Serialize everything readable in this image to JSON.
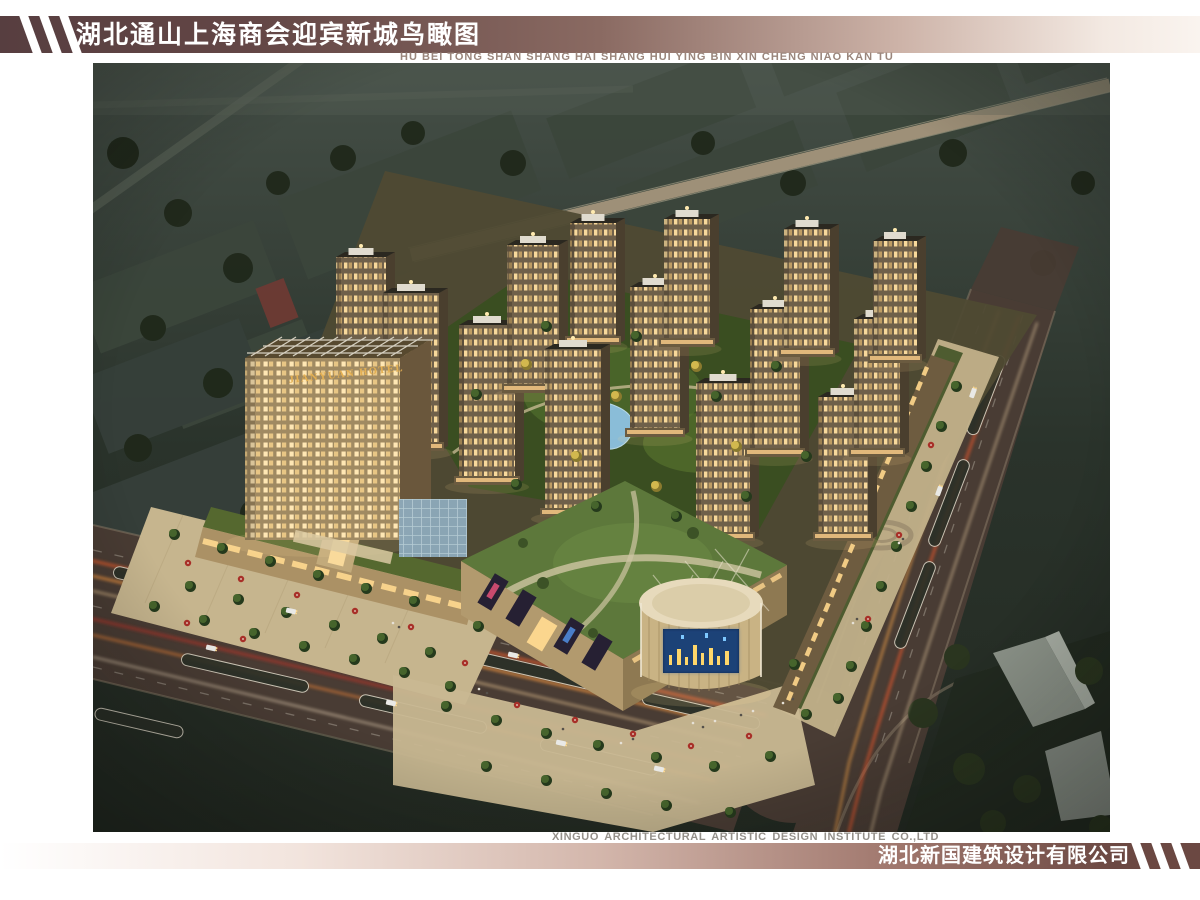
{
  "header": {
    "title_cn": "湖北通山上海商会迎宾新城鸟瞰图",
    "subtitle_pinyin": "HU BEI TONG SHAN SHANG HAI SHANG HUI YING BIN XIN CHENG NIAO KAN TU"
  },
  "footer": {
    "credit_en": "XINGUO ARCHITECTURAL ARTISTIC DESIGN INSTITUTE CO.,LTD",
    "company_cn": "湖北新国建筑设计有限公司"
  },
  "scene": {
    "hotel_sign": "JIANYUAN HOTEL",
    "colors": {
      "header_bar_dark": "#573e40",
      "header_bar_light": "#faf4ef",
      "title": "#ffffff",
      "pinyin": "#9a867c",
      "footer_bar_dark": "#6b4842",
      "footer_bar_light": "#ffffff",
      "credit": "#94908a",
      "company": "#ffffff",
      "night_ground": "#242c25",
      "tower_face": "#6f604a",
      "window_glow": "#ffdf9f",
      "lawn_roof": "#5d783b",
      "road": "#493c34",
      "light_trail": "#ff9c3e",
      "pond": "#8ec2e2",
      "plaza": "#c6b58e",
      "drum_roof": "#e7dabc",
      "led_screen": "#112a50",
      "hotel_sign_gold": "#e3af52"
    },
    "towers": [
      {
        "x": 268,
        "y": 332,
        "w": 50,
        "h": 138
      },
      {
        "x": 318,
        "y": 388,
        "w": 56,
        "h": 158
      },
      {
        "x": 394,
        "y": 422,
        "w": 56,
        "h": 160
      },
      {
        "x": 440,
        "y": 330,
        "w": 52,
        "h": 148
      },
      {
        "x": 500,
        "y": 282,
        "w": 46,
        "h": 122
      },
      {
        "x": 480,
        "y": 454,
        "w": 56,
        "h": 168
      },
      {
        "x": 562,
        "y": 374,
        "w": 50,
        "h": 150
      },
      {
        "x": 594,
        "y": 284,
        "w": 46,
        "h": 128
      },
      {
        "x": 630,
        "y": 478,
        "w": 54,
        "h": 158
      },
      {
        "x": 682,
        "y": 394,
        "w": 50,
        "h": 148
      },
      {
        "x": 714,
        "y": 294,
        "w": 46,
        "h": 128
      },
      {
        "x": 750,
        "y": 478,
        "w": 50,
        "h": 144
      },
      {
        "x": 784,
        "y": 394,
        "w": 46,
        "h": 138
      },
      {
        "x": 802,
        "y": 300,
        "w": 44,
        "h": 122
      }
    ],
    "trees": [
      [
        80,
        470,
        "s"
      ],
      [
        128,
        484,
        "s"
      ],
      [
        176,
        497,
        "s"
      ],
      [
        224,
        511,
        "s"
      ],
      [
        272,
        524,
        "s"
      ],
      [
        320,
        537,
        "s"
      ],
      [
        96,
        522,
        "s"
      ],
      [
        144,
        535,
        "s"
      ],
      [
        192,
        548,
        "s"
      ],
      [
        240,
        561,
        "s"
      ],
      [
        288,
        574,
        "s"
      ],
      [
        336,
        588,
        "s"
      ],
      [
        384,
        562,
        "s"
      ],
      [
        60,
        542,
        "s"
      ],
      [
        110,
        556,
        "s"
      ],
      [
        160,
        569,
        "s"
      ],
      [
        210,
        582,
        "s"
      ],
      [
        260,
        595,
        "s"
      ],
      [
        310,
        608,
        "s"
      ],
      [
        356,
        622,
        "s"
      ],
      [
        862,
        322,
        "s"
      ],
      [
        847,
        362,
        "s"
      ],
      [
        832,
        402,
        "s"
      ],
      [
        817,
        442,
        "s"
      ],
      [
        802,
        482,
        "s"
      ],
      [
        787,
        522,
        "s"
      ],
      [
        772,
        562,
        "s"
      ],
      [
        757,
        602,
        "s"
      ],
      [
        744,
        634,
        "s"
      ],
      [
        352,
        642,
        "s"
      ],
      [
        402,
        656,
        "s"
      ],
      [
        452,
        669,
        "s"
      ],
      [
        504,
        681,
        "s"
      ],
      [
        562,
        693,
        "s"
      ],
      [
        620,
        702,
        "s"
      ],
      [
        676,
        692,
        "s"
      ],
      [
        392,
        702,
        "s"
      ],
      [
        452,
        716,
        "s"
      ],
      [
        512,
        729,
        "s"
      ],
      [
        572,
        741,
        "s"
      ],
      [
        636,
        748,
        "s"
      ],
      [
        712,
        650,
        "s"
      ],
      [
        700,
        600,
        "s"
      ],
      [
        432,
        300,
        "y"
      ],
      [
        522,
        332,
        "y"
      ],
      [
        602,
        302,
        "y"
      ],
      [
        482,
        392,
        "y"
      ],
      [
        562,
        422,
        "y"
      ],
      [
        642,
        382,
        "y"
      ],
      [
        382,
        330,
        "s"
      ],
      [
        452,
        262,
        "s"
      ],
      [
        542,
        272,
        "s"
      ],
      [
        622,
        332,
        "s"
      ],
      [
        682,
        302,
        "s"
      ],
      [
        422,
        420,
        "s"
      ],
      [
        502,
        442,
        "s"
      ],
      [
        582,
        452,
        "s"
      ],
      [
        652,
        432,
        "s"
      ],
      [
        712,
        392,
        "s"
      ]
    ],
    "umbrellas": [
      [
        95,
        500
      ],
      [
        148,
        516
      ],
      [
        204,
        532
      ],
      [
        262,
        548
      ],
      [
        318,
        564
      ],
      [
        372,
        600
      ],
      [
        424,
        642
      ],
      [
        482,
        657
      ],
      [
        540,
        671
      ],
      [
        598,
        683
      ],
      [
        656,
        673
      ],
      [
        838,
        382
      ],
      [
        806,
        472
      ],
      [
        775,
        556
      ],
      [
        94,
        560
      ],
      [
        150,
        576
      ]
    ],
    "cars": [
      [
        118,
        585,
        13
      ],
      [
        298,
        640,
        13
      ],
      [
        468,
        680,
        13
      ],
      [
        198,
        548,
        13
      ],
      [
        420,
        592,
        13
      ],
      [
        880,
        330,
        -70
      ],
      [
        846,
        428,
        -70
      ],
      [
        566,
        706,
        13
      ]
    ],
    "people": [
      [
        600,
        660
      ],
      [
        610,
        664
      ],
      [
        622,
        658
      ],
      [
        648,
        652
      ],
      [
        660,
        648
      ],
      [
        540,
        676
      ],
      [
        528,
        680
      ],
      [
        470,
        666
      ],
      [
        690,
        640
      ],
      [
        700,
        636
      ],
      [
        386,
        626
      ],
      [
        394,
        630
      ],
      [
        300,
        560
      ],
      [
        306,
        564
      ],
      [
        760,
        560
      ],
      [
        764,
        556
      ],
      [
        806,
        480
      ],
      [
        810,
        476
      ]
    ],
    "medians": [
      [
        84,
        523,
        130,
        13
      ],
      [
        262,
        565,
        130,
        13
      ],
      [
        438,
        607,
        130,
        13
      ],
      [
        608,
        648,
        120,
        13
      ],
      [
        152,
        610,
        130,
        13
      ],
      [
        330,
        651,
        130,
        13
      ],
      [
        506,
        694,
        120,
        13
      ],
      [
        46,
        660,
        90,
        13
      ],
      [
        893,
        332,
        84,
        -69
      ],
      [
        856,
        440,
        92,
        -69
      ],
      [
        822,
        542,
        92,
        -69
      ]
    ]
  }
}
